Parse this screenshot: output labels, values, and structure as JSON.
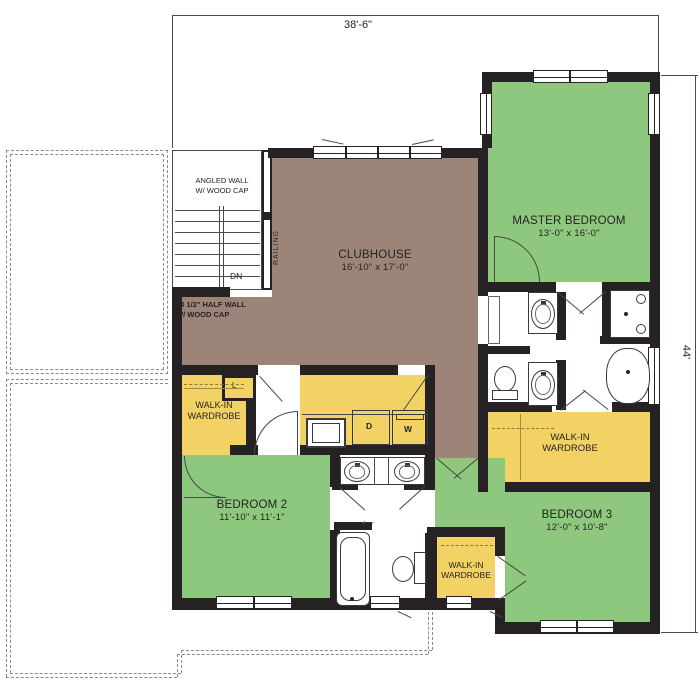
{
  "dims": {
    "width": "38'-6\"",
    "height": "44'"
  },
  "rooms": {
    "clubhouse": {
      "name": "CLUBHOUSE",
      "size": "16'-10\" x 17'-0\""
    },
    "master_bedroom": {
      "name": "MASTER BEDROOM",
      "size": "13'-0\" x 16'-0\""
    },
    "bedroom2": {
      "name": "BEDROOM 2",
      "size": "11'-10\" x 11'-1\""
    },
    "bedroom3": {
      "name": "BEDROOM 3",
      "size": "12'-0\" x 10'-8\""
    }
  },
  "wardrobe": {
    "line1": "WALK-IN",
    "line2": "WARDROBE"
  },
  "notes": {
    "angled_wall_1": "ANGLED WALL",
    "angled_wall_2": "W/ WOOD CAP",
    "half_wall_1": "44 1/2\" HALF WALL",
    "half_wall_2": "W/ WOOD CAP",
    "railing": "RAILING",
    "down": "DN",
    "linen": "L",
    "dryer": "D",
    "washer": "W",
    "arrow": "←"
  },
  "colors": {
    "bedroom_green": "#8ec87e",
    "wardrobe_yellow": "#f2d264",
    "clubhouse_brown": "#9c8478",
    "wall_black": "#262223"
  }
}
